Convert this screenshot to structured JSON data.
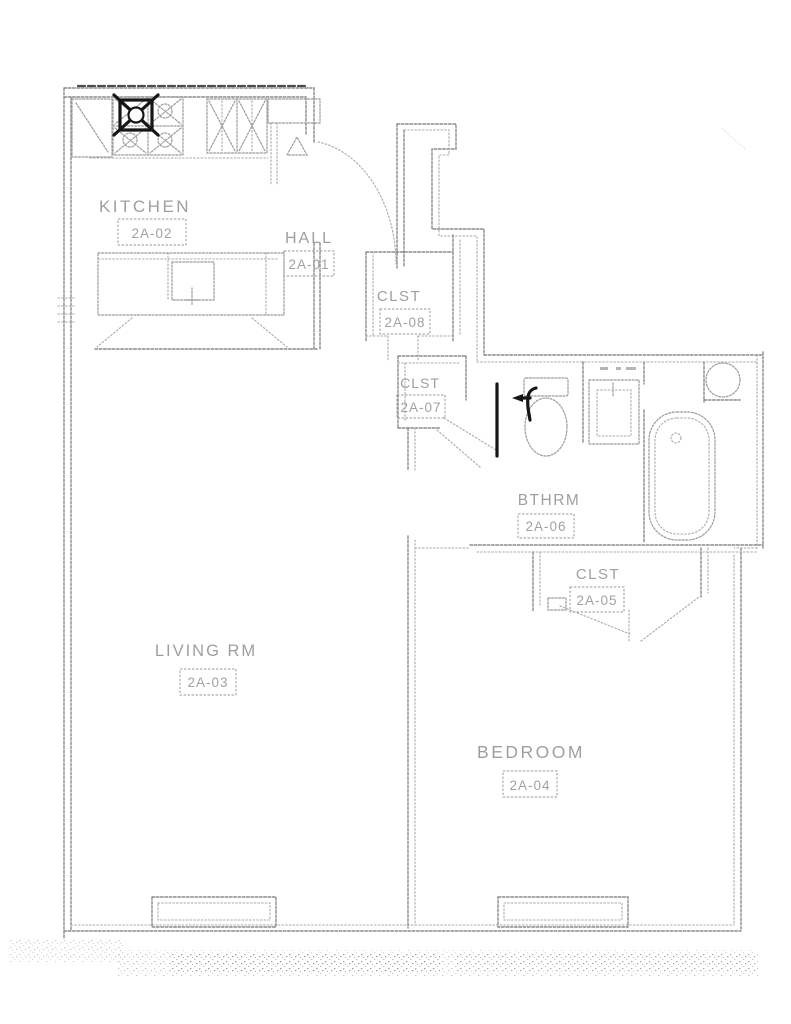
{
  "plan": {
    "type": "apartment-floor-plan-scan",
    "unit_prefix": "2A",
    "rooms": [
      {
        "id": "hall",
        "name": "HALL",
        "tag": "2A-01"
      },
      {
        "id": "kitchen",
        "name": "KITCHEN",
        "tag": "2A-02"
      },
      {
        "id": "living-room",
        "name": "LIVING RM",
        "tag": "2A-03"
      },
      {
        "id": "bedroom",
        "name": "BEDROOM",
        "tag": "2A-04"
      },
      {
        "id": "closet-bedroom",
        "name": "CLST",
        "tag": "2A-05"
      },
      {
        "id": "bathroom",
        "name": "BTHRM",
        "tag": "2A-06"
      },
      {
        "id": "closet-hall-south",
        "name": "CLST",
        "tag": "2A-07"
      },
      {
        "id": "closet-hall",
        "name": "CLST",
        "tag": "2A-08"
      }
    ],
    "colors": {
      "paper": "#ffffff",
      "wall_line": "#8c8c8c",
      "bold_ink": "#161616",
      "label_text": "#979797"
    }
  }
}
